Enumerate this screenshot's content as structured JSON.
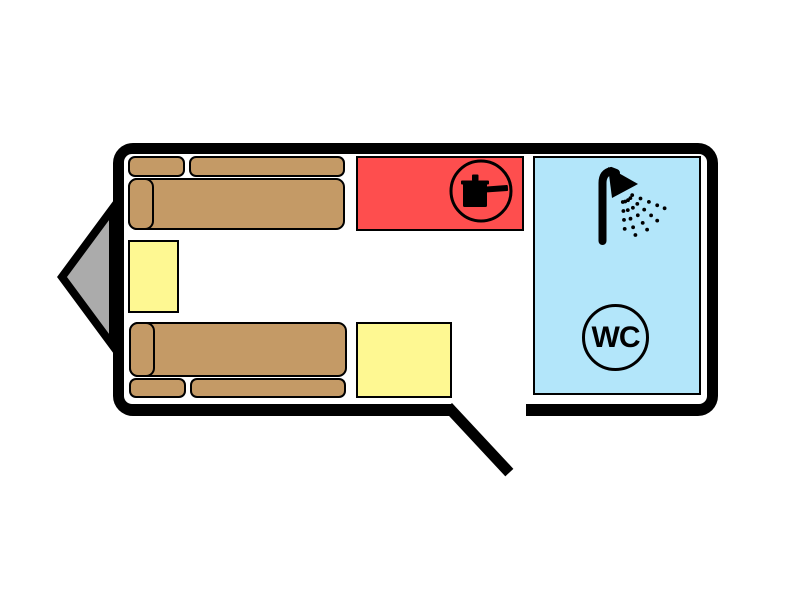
{
  "colors": {
    "background": "#FFFFFF",
    "wall": "#000000",
    "floor": "#FFFFFF",
    "border": "#000000",
    "hitch": "#ABABAB",
    "sofa": "#C49A66",
    "table": "#FEF892",
    "kitchen": "#FE4E4E",
    "bathroom": "#B3E6FA",
    "icon": "#000000"
  },
  "kitchen": {
    "icon": "cooking-pot-icon"
  },
  "bathroom": {
    "wc_label": "WC",
    "icons": [
      "shower-icon",
      "wc-icon"
    ]
  },
  "furniture": [
    "sofa-top",
    "sofa-bottom",
    "cabinet-left",
    "table-bottom",
    "kitchen-unit",
    "bathroom"
  ]
}
